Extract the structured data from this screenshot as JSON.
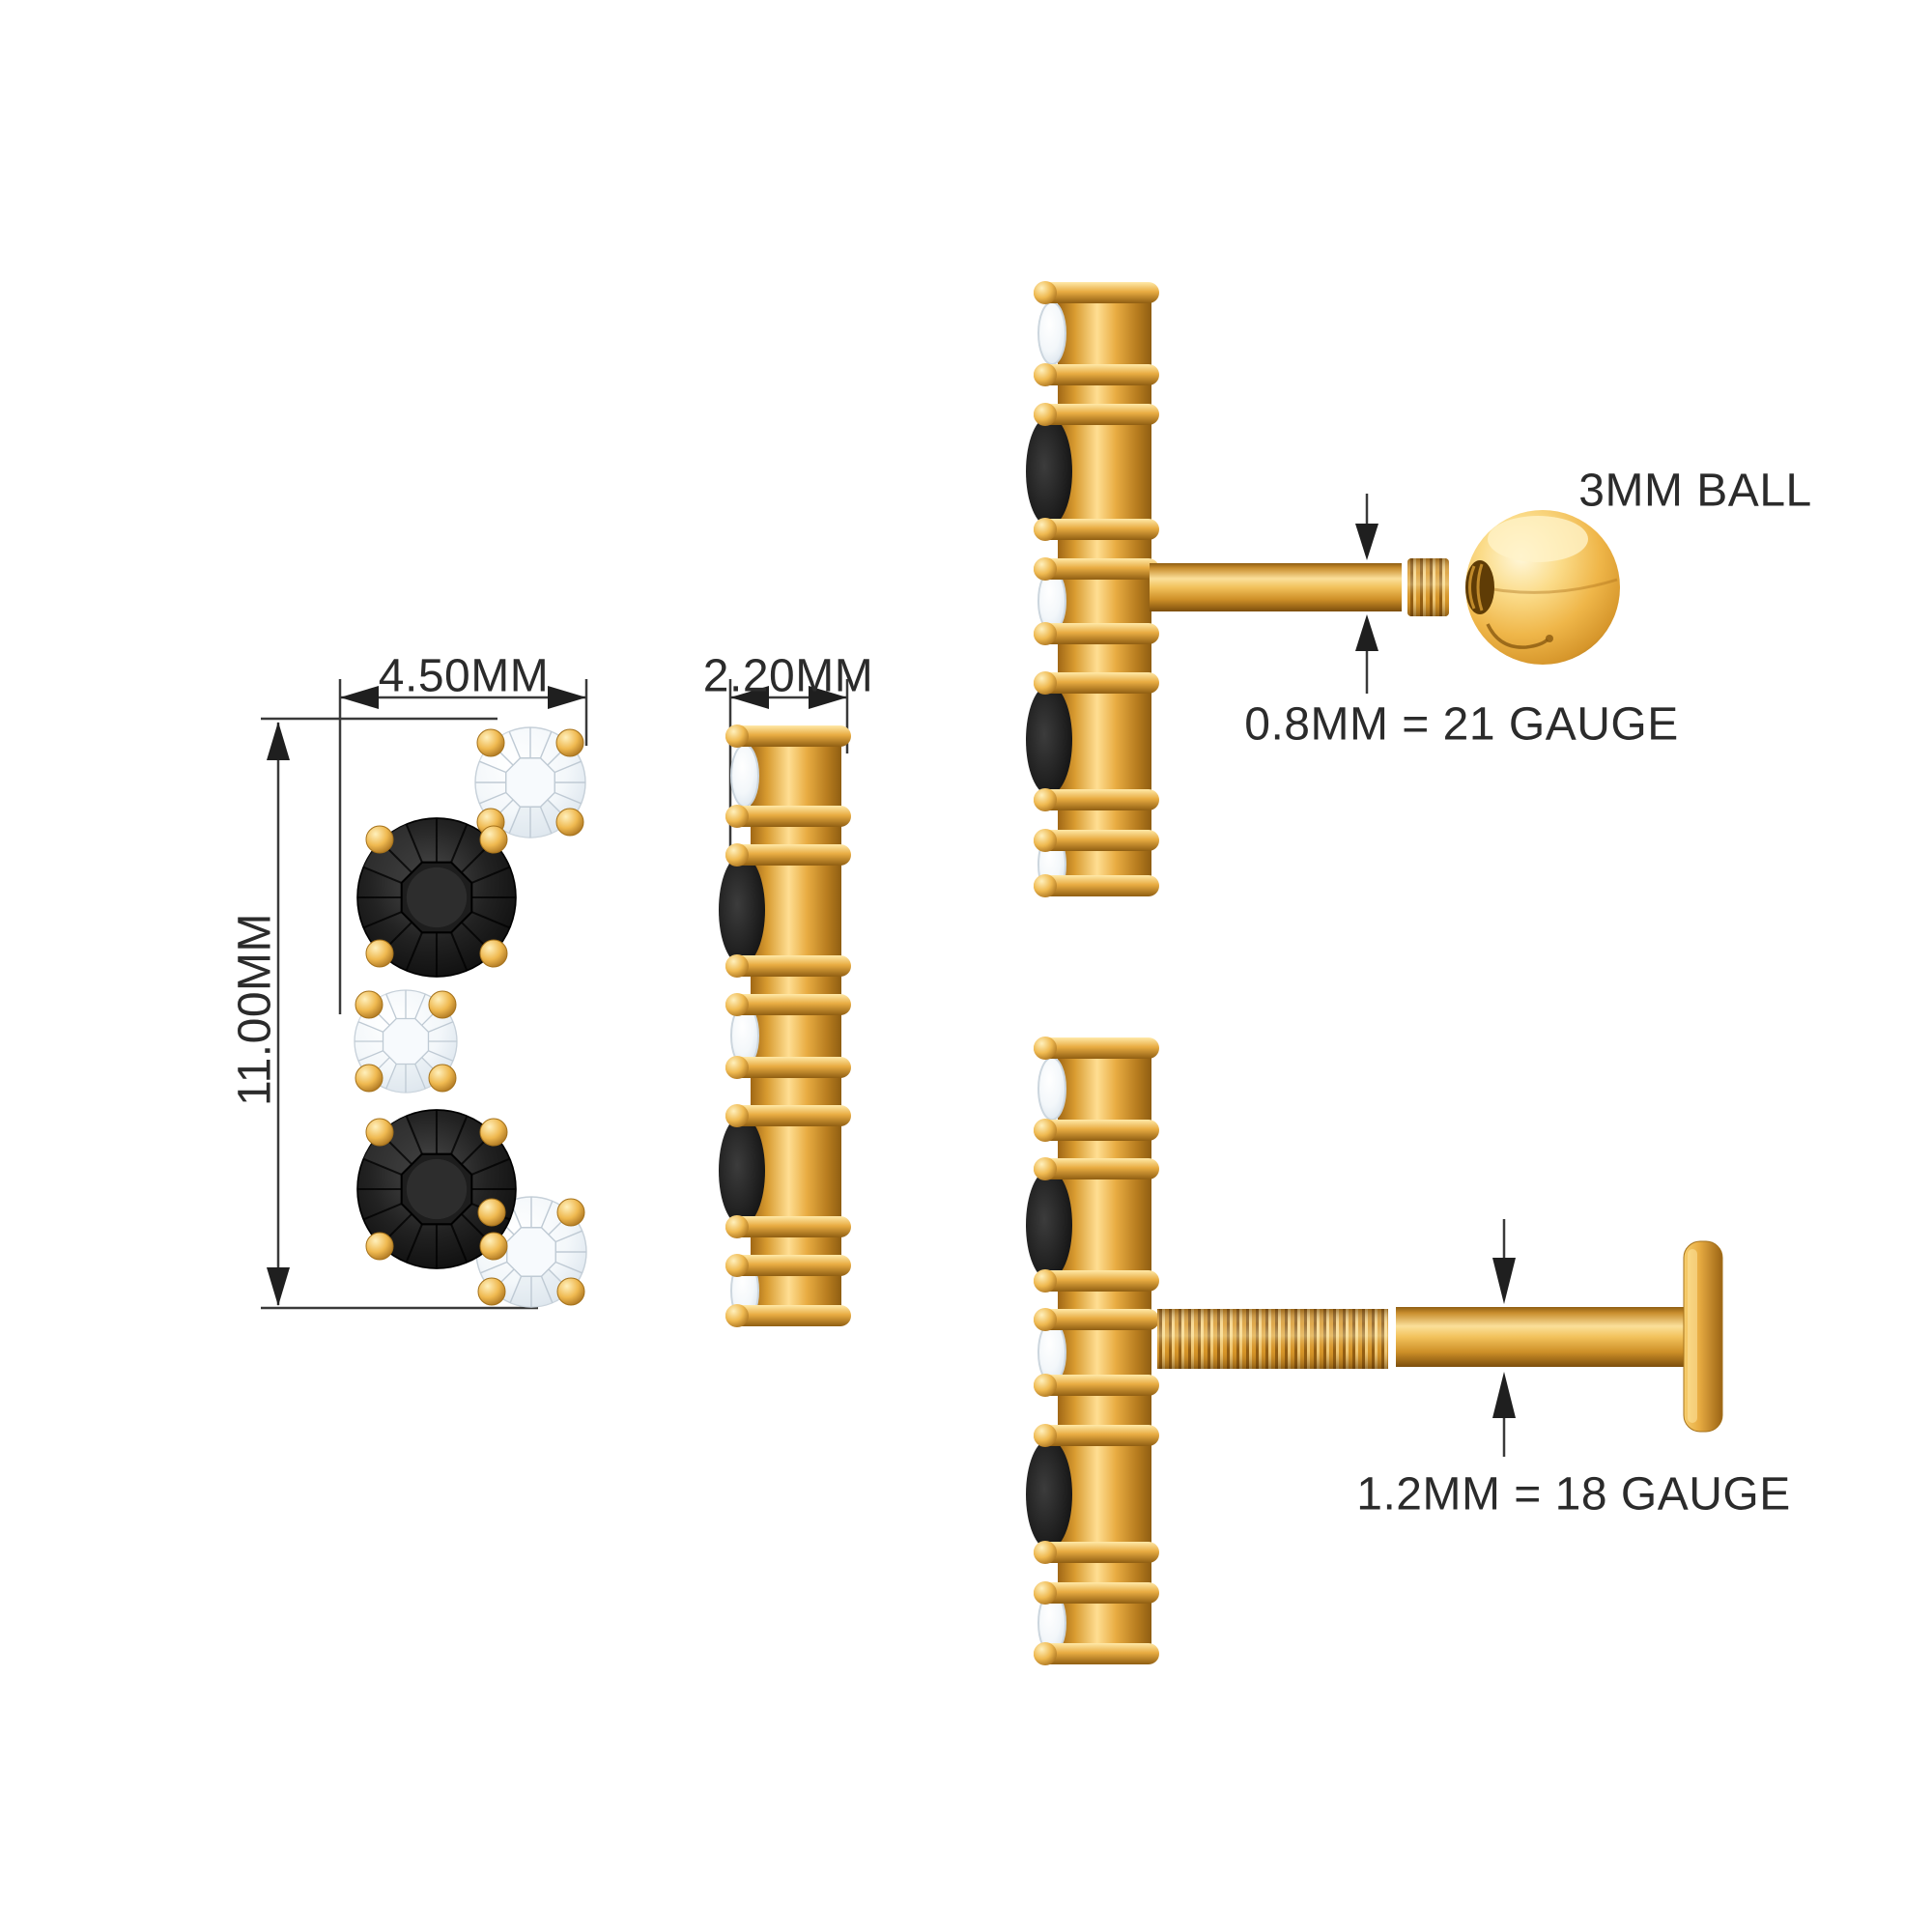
{
  "views": {
    "front": {
      "width_label": "4.50MM",
      "height_label": "11.00MM"
    },
    "side": {
      "depth_label": "2.20MM"
    },
    "screw_back": {
      "ball_label": "3MM BALL",
      "gauge_label": "0.8MM = 21 GAUGE"
    },
    "flat_back": {
      "gauge_label": "1.2MM = 18 GAUGE"
    }
  },
  "colors": {
    "gold": "#E8A93F",
    "gold_light": "#FFDE92",
    "gold_dark": "#8F5E12",
    "black_stone": "#151515",
    "diamond": "#EEF3F8",
    "line": "#3a3a3a",
    "text": "#2b2b2b",
    "background": "#FFFFFF"
  }
}
